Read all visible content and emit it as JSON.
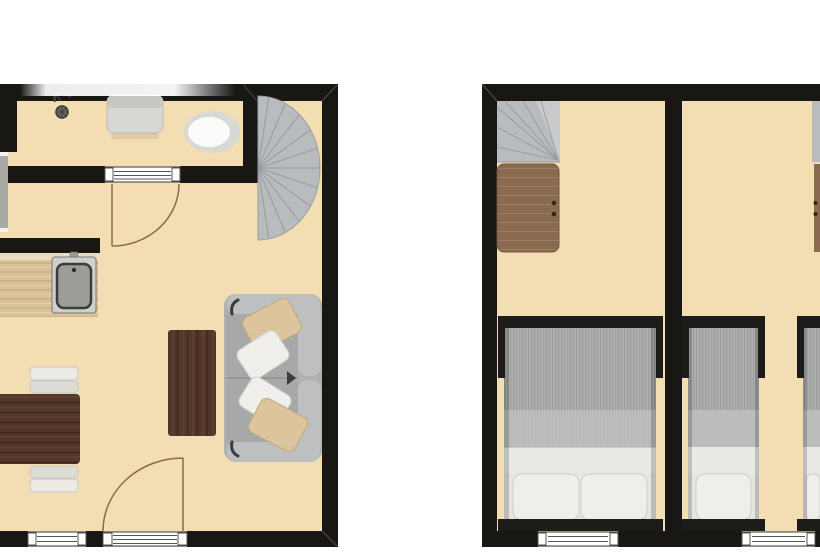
{
  "meta": {
    "description": "Two-storey holiday apartment floor plan, ground floor (left) and upper floor (right), no text labels visible"
  },
  "colors": {
    "background": "#ffffff",
    "floor": "#f3ddb3",
    "wall": "#191714",
    "stair_fill": "#b9bcbf",
    "stair_fill_light": "#caccce",
    "stair_line": "#94979b",
    "wood_counter": "#d9c298",
    "wood_counter_edge": "#ece0c4",
    "walnut": "#53372b",
    "desk_wood": "#8a6b4f",
    "sofa_base": "#aeb0b2",
    "sofa_light": "#bdbfc1",
    "sofa_seat": "#a6a8aa",
    "pillow_beige": "#dcc49c",
    "pillow_white": "#efeeea",
    "mattress": "#a9a9a7",
    "mattress_light": "#bcbcba",
    "sheet_white": "#eae9e6",
    "pillow_zone": "#e6e5e1",
    "bed_frame": "#1c1c1a",
    "window_fill": "#ffffff",
    "door_arc": "#8d6b42",
    "fixture_gray": "#a9a9a5",
    "sink_steel": "#9c9c98",
    "ceramic_white": "#fbfbf9",
    "ceramic_rim": "#d8d8d4",
    "vanity_gray": "#d7d7d4",
    "vanity_gray_dark": "#c6c6c2",
    "chair_light": "#eceae6",
    "chair_dark": "#dedcd7",
    "fade": "#ffffff"
  },
  "ground_floor": {
    "name": "ground-floor",
    "rooms": [
      "bathroom",
      "stair-nook",
      "kitchen-living-room"
    ],
    "furniture": [
      "shower-fixture",
      "bathroom-vanity",
      "toilet",
      "spiral-staircase",
      "kitchen-counter",
      "kitchen-sink",
      "dining-table",
      "dining-chairs",
      "coffee-table",
      "sofa",
      "sofa-pillows",
      "bathroom-door",
      "entry-door",
      "window"
    ]
  },
  "upper_floor": {
    "name": "upper-floor",
    "rooms": [
      "bedroom-left",
      "bedroom-right"
    ],
    "furniture": [
      "stair-landing",
      "desk",
      "double-bed",
      "single-bed",
      "single-bed-cropped",
      "windows"
    ]
  }
}
